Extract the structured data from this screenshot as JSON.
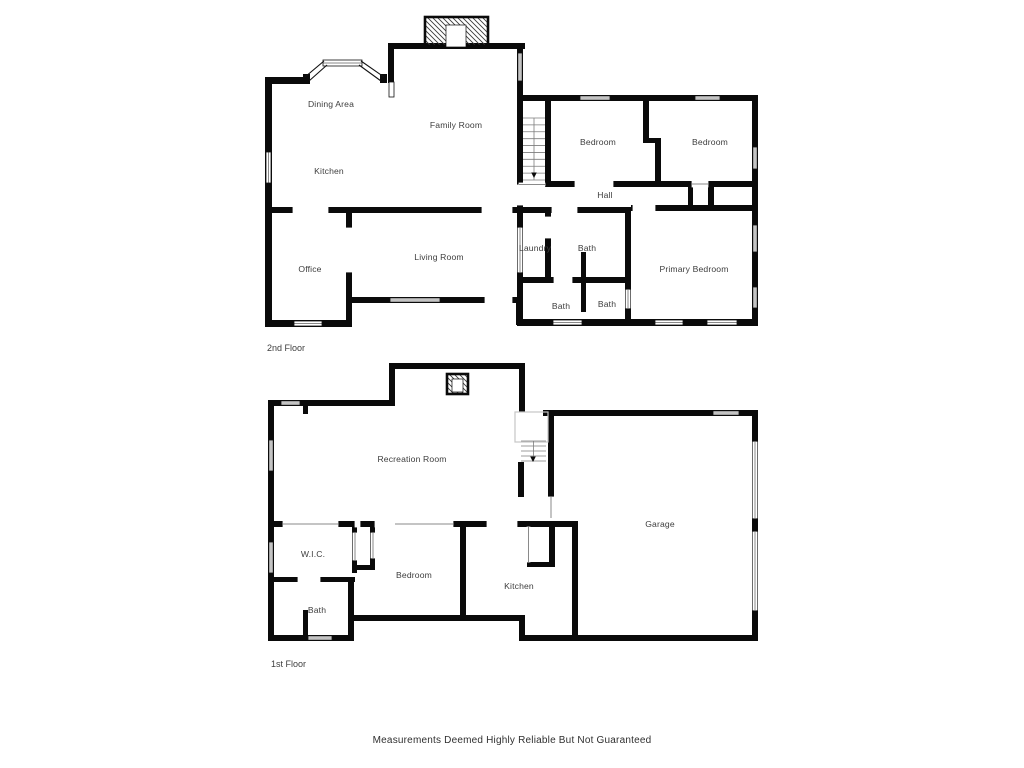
{
  "page": {
    "background": "#ffffff",
    "disclaimer": "Measurements Deemed Highly Reliable But Not Guaranteed"
  },
  "colors": {
    "wall": "#0a0a0a",
    "label": "#3d3d3d",
    "opening_line": "#8a8a8a",
    "stair_line": "#7d7d7d",
    "floor_outline": "#c6c6c6",
    "window_stroke": "#111111"
  },
  "floors": [
    {
      "id": "second",
      "label": "2nd Floor",
      "label_x": 267,
      "label_y": 351,
      "rooms": [
        {
          "name": "Dining Area",
          "x": 331,
          "y": 107
        },
        {
          "name": "Family Room",
          "x": 456,
          "y": 128
        },
        {
          "name": "Kitchen",
          "x": 329,
          "y": 174
        },
        {
          "name": "Bedroom",
          "x": 598,
          "y": 145
        },
        {
          "name": "Bedroom",
          "x": 710,
          "y": 145
        },
        {
          "name": "Hall",
          "x": 605,
          "y": 198
        },
        {
          "name": "Office",
          "x": 310,
          "y": 272
        },
        {
          "name": "Living Room",
          "x": 439,
          "y": 260
        },
        {
          "name": "Laundry",
          "x": 535,
          "y": 251
        },
        {
          "name": "Bath",
          "x": 587,
          "y": 251
        },
        {
          "name": "Primary Bedroom",
          "x": 694,
          "y": 272
        },
        {
          "name": "Bath",
          "x": 561,
          "y": 309
        },
        {
          "name": "Bath",
          "x": 607,
          "y": 307
        }
      ],
      "walls": [
        [
          265,
          77,
          7,
          248
        ],
        [
          265,
          77,
          45,
          7
        ],
        [
          303,
          74,
          7,
          9
        ],
        [
          380,
          74,
          7,
          9
        ],
        [
          388,
          43,
          6,
          40
        ],
        [
          388,
          43,
          137,
          6
        ],
        [
          517,
          43,
          6,
          282
        ],
        [
          517,
          95,
          241,
          6
        ],
        [
          752,
          95,
          6,
          230
        ],
        [
          517,
          319,
          241,
          7
        ],
        [
          545,
          95,
          6,
          90
        ],
        [
          643,
          95,
          6,
          46
        ],
        [
          643,
          138,
          18,
          5
        ],
        [
          655,
          143,
          6,
          42
        ],
        [
          545,
          181,
          147,
          6
        ],
        [
          714,
          181,
          38,
          6
        ],
        [
          708,
          181,
          6,
          30
        ],
        [
          688,
          186,
          5,
          20
        ],
        [
          631,
          205,
          127,
          6
        ],
        [
          517,
          207,
          114,
          6
        ],
        [
          265,
          207,
          252,
          6
        ],
        [
          346,
          213,
          6,
          109
        ],
        [
          265,
          320,
          87,
          7
        ],
        [
          346,
          297,
          176,
          6
        ],
        [
          516,
          297,
          7,
          28
        ],
        [
          545,
          213,
          6,
          69
        ],
        [
          517,
          277,
          114,
          6
        ],
        [
          581,
          252,
          5,
          60
        ],
        [
          625,
          207,
          6,
          118
        ]
      ],
      "gaps": [
        [
          575,
          181,
          38,
          6
        ],
        [
          633,
          205,
          22,
          6
        ],
        [
          552,
          207,
          25,
          6
        ],
        [
          293,
          207,
          35,
          6
        ],
        [
          482,
          207,
          30,
          6
        ],
        [
          346,
          228,
          6,
          44
        ],
        [
          485,
          297,
          27,
          6
        ],
        [
          554,
          277,
          18,
          6
        ],
        [
          517,
          185,
          6,
          20
        ],
        [
          545,
          217,
          6,
          21
        ]
      ],
      "openings": [
        [
          692,
          181,
          16,
          6,
          "h"
        ],
        [
          518,
          228,
          4,
          44,
          "v"
        ],
        [
          626,
          290,
          4,
          18,
          "v"
        ],
        [
          519,
          183,
          26,
          3,
          "h"
        ]
      ],
      "windows": [
        [
          518,
          53,
          4,
          28
        ],
        [
          266,
          152,
          5,
          31
        ],
        [
          580,
          96,
          30,
          4
        ],
        [
          695,
          96,
          25,
          4
        ],
        [
          753,
          147,
          4,
          22
        ],
        [
          753,
          225,
          4,
          27
        ],
        [
          753,
          287,
          4,
          21
        ],
        [
          294,
          321,
          28,
          5
        ],
        [
          390,
          298,
          50,
          4
        ],
        [
          553,
          320,
          29,
          5
        ],
        [
          655,
          320,
          28,
          5
        ],
        [
          707,
          320,
          30,
          5
        ],
        [
          389,
          82,
          5,
          15
        ],
        [
          323,
          60,
          39,
          6
        ]
      ],
      "bay_lines": [
        [
          305,
          77,
          324,
          61
        ],
        [
          309,
          81,
          327,
          65
        ],
        [
          361,
          61,
          384,
          77
        ],
        [
          359,
          65,
          381,
          81
        ]
      ],
      "outlines": [],
      "stairs": [
        {
          "x": 523,
          "y": 118,
          "w": 22,
          "h": 62,
          "treads": 9,
          "center": true,
          "arrow": [
            534,
            176
          ]
        }
      ],
      "chimneys": [
        {
          "x": 425,
          "y": 17,
          "w": 63,
          "h": 29,
          "core": [
            446,
            25,
            20,
            22
          ]
        }
      ]
    },
    {
      "id": "first",
      "label": "1st Floor",
      "label_x": 271,
      "label_y": 667,
      "rooms": [
        {
          "name": "Recreation Room",
          "x": 412,
          "y": 462
        },
        {
          "name": "Garage",
          "x": 660,
          "y": 527
        },
        {
          "name": "W.I.C.",
          "x": 313,
          "y": 557
        },
        {
          "name": "Bedroom",
          "x": 414,
          "y": 578
        },
        {
          "name": "Kitchen",
          "x": 519,
          "y": 589
        },
        {
          "name": "Bath",
          "x": 317,
          "y": 613
        }
      ],
      "walls": [
        [
          389,
          363,
          136,
          6
        ],
        [
          389,
          363,
          6,
          43
        ],
        [
          519,
          363,
          6,
          49
        ],
        [
          268,
          400,
          127,
          6
        ],
        [
          303,
          400,
          5,
          14
        ],
        [
          268,
          400,
          6,
          241
        ],
        [
          268,
          521,
          310,
          6
        ],
        [
          352,
          521,
          5,
          52
        ],
        [
          370,
          521,
          5,
          49
        ],
        [
          352,
          565,
          23,
          5
        ],
        [
          268,
          577,
          87,
          5
        ],
        [
          348,
          577,
          6,
          64
        ],
        [
          303,
          610,
          5,
          27
        ],
        [
          268,
          635,
          86,
          6
        ],
        [
          348,
          615,
          177,
          6
        ],
        [
          519,
          615,
          6,
          26
        ],
        [
          519,
          635,
          239,
          6
        ],
        [
          460,
          521,
          6,
          100
        ],
        [
          572,
          521,
          6,
          120
        ],
        [
          549,
          521,
          6,
          46
        ],
        [
          527,
          562,
          28,
          5
        ],
        [
          548,
          410,
          6,
          87
        ],
        [
          518,
          462,
          6,
          35
        ],
        [
          543,
          410,
          215,
          6
        ],
        [
          752,
          410,
          6,
          231
        ]
      ],
      "gaps": [
        [
          355,
          521,
          5,
          6
        ],
        [
          375,
          521,
          20,
          6
        ],
        [
          487,
          521,
          30,
          6
        ],
        [
          298,
          577,
          22,
          5
        ]
      ],
      "openings": [
        [
          283,
          521,
          55,
          6,
          "h"
        ],
        [
          395,
          521,
          58,
          6,
          "h"
        ],
        [
          353,
          533,
          4,
          27,
          "v"
        ],
        [
          371,
          533,
          4,
          25,
          "v"
        ],
        [
          527,
          527,
          3,
          35,
          "v"
        ],
        [
          548,
          497,
          6,
          21,
          "v"
        ],
        [
          753,
          442,
          4,
          76,
          "v"
        ],
        [
          753,
          532,
          4,
          78,
          "v"
        ]
      ],
      "windows": [
        [
          281,
          401,
          19,
          4
        ],
        [
          269,
          440,
          4,
          31
        ],
        [
          269,
          542,
          4,
          31
        ],
        [
          308,
          636,
          24,
          4
        ],
        [
          713,
          411,
          26,
          4
        ]
      ],
      "bay_lines": [],
      "outlines": [
        [
          515,
          412,
          33,
          30
        ]
      ],
      "stairs": [
        {
          "x": 521,
          "y": 441,
          "w": 25,
          "h": 20,
          "treads": 4,
          "center": true,
          "arrow": [
            533,
            460
          ]
        }
      ],
      "chimneys": [
        {
          "x": 447,
          "y": 374,
          "w": 21,
          "h": 20,
          "core": [
            452,
            379,
            11,
            13
          ]
        }
      ]
    }
  ]
}
